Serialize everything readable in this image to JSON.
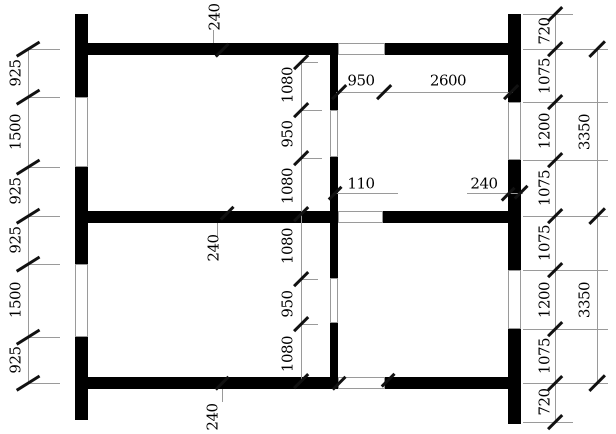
{
  "page": {
    "width": 616,
    "height": 434,
    "background": "#ffffff"
  },
  "drawing": {
    "type": "architectural-floor-plan",
    "wall_color": "#000000",
    "dimension_line_color": "#9a9a9a",
    "tick_color": "#111111",
    "text_color": "#000000",
    "walls": [
      [
        75,
        14,
        13,
        83
      ],
      [
        75,
        167,
        13,
        97
      ],
      [
        75,
        337,
        13,
        83
      ],
      [
        508,
        14,
        13,
        88
      ],
      [
        508,
        160,
        13,
        110
      ],
      [
        508,
        329,
        13,
        95
      ],
      [
        75,
        43,
        263,
        12
      ],
      [
        385,
        43,
        136,
        12
      ],
      [
        75,
        211,
        263,
        12
      ],
      [
        383,
        211,
        138,
        12
      ],
      [
        75,
        377,
        263,
        12
      ],
      [
        385,
        377,
        136,
        12
      ],
      [
        330,
        43,
        8,
        67
      ],
      [
        330,
        157,
        8,
        121
      ],
      [
        330,
        323,
        8,
        66
      ]
    ],
    "window_openings": [
      [
        75,
        97,
        13,
        70
      ],
      [
        75,
        264,
        13,
        73
      ],
      [
        508,
        102,
        13,
        58
      ],
      [
        508,
        270,
        13,
        59
      ],
      [
        338,
        43,
        47,
        12
      ],
      [
        338,
        211,
        45,
        12
      ],
      [
        338,
        377,
        47,
        12
      ],
      [
        330,
        110,
        8,
        47
      ],
      [
        330,
        278,
        8,
        45
      ]
    ],
    "lines": [
      [
        28,
        49,
        28,
        383
      ],
      [
        28,
        49,
        60,
        49
      ],
      [
        28,
        97,
        60,
        97
      ],
      [
        28,
        167,
        60,
        167
      ],
      [
        28,
        216,
        60,
        216
      ],
      [
        28,
        264,
        60,
        264
      ],
      [
        28,
        337,
        60,
        337
      ],
      [
        28,
        383,
        60,
        383
      ],
      [
        301,
        62,
        301,
        381
      ],
      [
        301,
        62,
        318,
        62
      ],
      [
        301,
        110,
        322,
        110
      ],
      [
        301,
        158,
        322,
        158
      ],
      [
        301,
        279,
        318,
        279
      ],
      [
        301,
        324,
        318,
        324
      ],
      [
        555,
        14,
        555,
        422
      ],
      [
        597,
        49,
        597,
        383
      ],
      [
        523,
        14,
        573,
        14
      ],
      [
        523,
        49,
        608,
        49
      ],
      [
        523,
        102,
        608,
        102
      ],
      [
        523,
        160,
        608,
        160
      ],
      [
        523,
        216,
        608,
        216
      ],
      [
        523,
        270,
        608,
        270
      ],
      [
        523,
        329,
        608,
        329
      ],
      [
        523,
        383,
        608,
        383
      ],
      [
        523,
        422,
        573,
        422
      ],
      [
        336,
        92,
        513,
        92
      ],
      [
        333,
        193,
        398,
        193
      ],
      [
        467,
        193,
        523,
        193
      ],
      [
        213,
        30,
        213,
        43
      ],
      [
        217,
        223,
        217,
        237
      ],
      [
        222,
        389,
        222,
        402
      ]
    ],
    "ticks": [
      [
        28,
        49,
        27,
        -32
      ],
      [
        28,
        97,
        27,
        -32
      ],
      [
        28,
        167,
        27,
        -32
      ],
      [
        28,
        216,
        27,
        -32
      ],
      [
        28,
        264,
        27,
        -32
      ],
      [
        28,
        337,
        27,
        -32
      ],
      [
        28,
        383,
        27,
        -32
      ],
      [
        301,
        62,
        20,
        -45
      ],
      [
        301,
        110,
        20,
        -45
      ],
      [
        301,
        158,
        20,
        -45
      ],
      [
        301,
        214,
        20,
        -45
      ],
      [
        301,
        279,
        20,
        -45
      ],
      [
        301,
        324,
        20,
        -45
      ],
      [
        301,
        381,
        20,
        -45
      ],
      [
        555,
        14,
        20,
        -45
      ],
      [
        555,
        49,
        20,
        -45
      ],
      [
        555,
        102,
        20,
        -45
      ],
      [
        555,
        160,
        20,
        -45
      ],
      [
        555,
        216,
        20,
        -45
      ],
      [
        555,
        270,
        20,
        -45
      ],
      [
        555,
        329,
        20,
        -45
      ],
      [
        555,
        383,
        20,
        -45
      ],
      [
        555,
        422,
        20,
        -45
      ],
      [
        597,
        49,
        22,
        -45
      ],
      [
        597,
        216,
        22,
        -45
      ],
      [
        597,
        383,
        22,
        -45
      ],
      [
        339,
        92,
        20,
        -45
      ],
      [
        384,
        92,
        20,
        -45
      ],
      [
        511,
        92,
        20,
        -45
      ],
      [
        335,
        193,
        18,
        -45
      ],
      [
        508,
        194,
        18,
        -45
      ],
      [
        521,
        192,
        18,
        -45
      ],
      [
        222,
        50,
        18,
        -45
      ],
      [
        227,
        213,
        18,
        -45
      ],
      [
        222,
        383,
        18,
        -45
      ],
      [
        339,
        383,
        18,
        -45
      ],
      [
        388,
        380,
        18,
        -45
      ]
    ],
    "labels": [
      {
        "text": "925",
        "x": 16,
        "y": 73,
        "rot": -90
      },
      {
        "text": "1500",
        "x": 16,
        "y": 132,
        "rot": -90
      },
      {
        "text": "925",
        "x": 16,
        "y": 191,
        "rot": -90
      },
      {
        "text": "925",
        "x": 16,
        "y": 240,
        "rot": -90
      },
      {
        "text": "1500",
        "x": 16,
        "y": 300,
        "rot": -90
      },
      {
        "text": "925",
        "x": 16,
        "y": 360,
        "rot": -90
      },
      {
        "text": "1080",
        "x": 288,
        "y": 85,
        "rot": -90
      },
      {
        "text": "950",
        "x": 288,
        "y": 134,
        "rot": -90
      },
      {
        "text": "1080",
        "x": 288,
        "y": 186,
        "rot": -90
      },
      {
        "text": "1080",
        "x": 288,
        "y": 246,
        "rot": -90
      },
      {
        "text": "950",
        "x": 288,
        "y": 304,
        "rot": -90
      },
      {
        "text": "1080",
        "x": 288,
        "y": 354,
        "rot": -90
      },
      {
        "text": "720",
        "x": 545,
        "y": 31,
        "rot": -90
      },
      {
        "text": "1075",
        "x": 545,
        "y": 76,
        "rot": -90
      },
      {
        "text": "1200",
        "x": 545,
        "y": 131,
        "rot": -90
      },
      {
        "text": "1075",
        "x": 545,
        "y": 188,
        "rot": -90
      },
      {
        "text": "1075",
        "x": 545,
        "y": 243,
        "rot": -90
      },
      {
        "text": "1200",
        "x": 545,
        "y": 300,
        "rot": -90
      },
      {
        "text": "1075",
        "x": 545,
        "y": 356,
        "rot": -90
      },
      {
        "text": "720",
        "x": 545,
        "y": 402,
        "rot": -90
      },
      {
        "text": "3350",
        "x": 585,
        "y": 132,
        "rot": -90
      },
      {
        "text": "3350",
        "x": 585,
        "y": 300,
        "rot": -90
      },
      {
        "text": "240",
        "x": 215,
        "y": 17,
        "rot": -90
      },
      {
        "text": "240",
        "x": 214,
        "y": 248,
        "rot": -90
      },
      {
        "text": "240",
        "x": 213,
        "y": 417,
        "rot": -90
      },
      {
        "text": "950",
        "x": 361,
        "y": 81,
        "rot": 0
      },
      {
        "text": "2600",
        "x": 448,
        "y": 81,
        "rot": 0
      },
      {
        "text": "110",
        "x": 361,
        "y": 184,
        "rot": 0
      },
      {
        "text": "240",
        "x": 484,
        "y": 184,
        "rot": 0
      }
    ]
  }
}
